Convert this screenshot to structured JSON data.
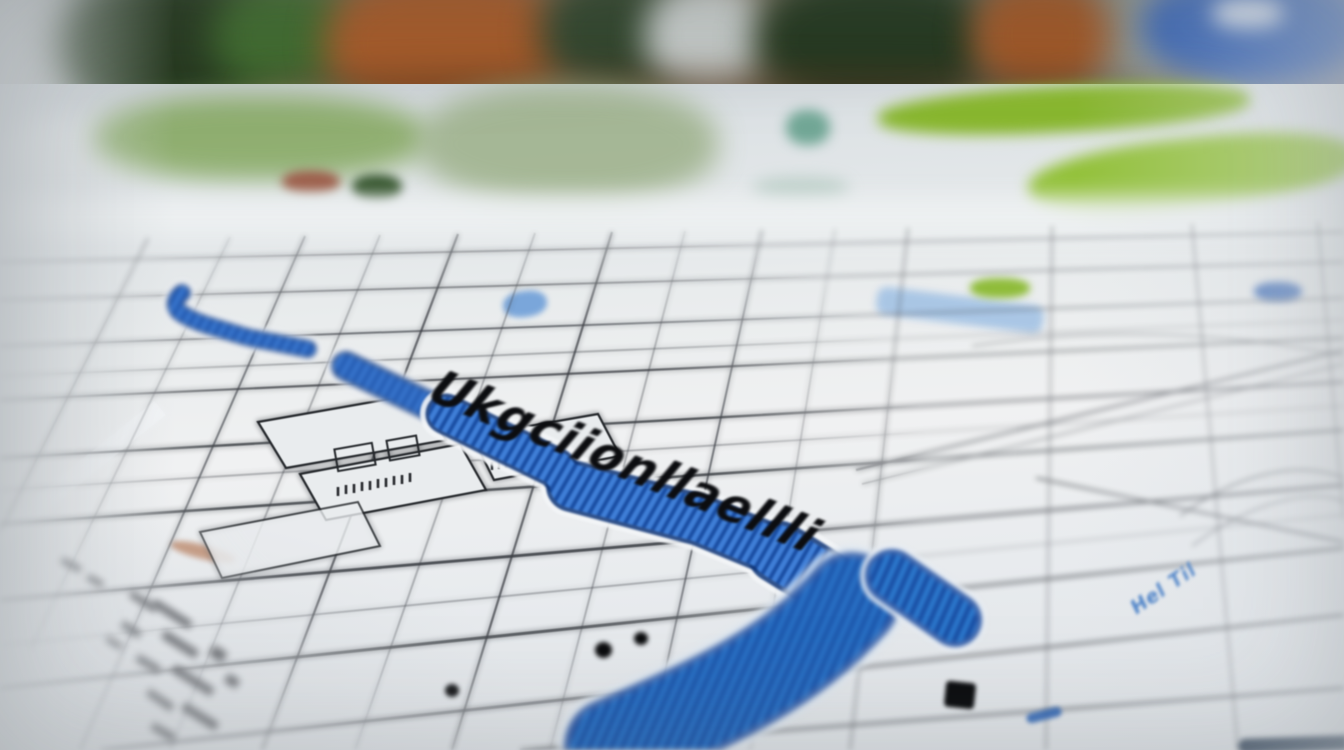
{
  "image": {
    "type": "photograph",
    "subject": "Close-up photo of a printed street map with a blue highlighted route, blurred outdoor background",
    "route_label": "Ukgciionllaellli",
    "street_label": "Hel Til",
    "colors": {
      "route_blue": "#3f7ed6",
      "route_dark_blue": "#1b4fa4",
      "paper": "#eceef0",
      "street_line": "#3b3e44",
      "park_green_bright": "#8ab832",
      "park_green_muted": "#7ea355",
      "water_blue": "#6f9fd8",
      "background_wall_orange": "#a65a28",
      "background_foliage_green": "#2c3f24",
      "background_object_blue": "#2757ae"
    },
    "markers": {
      "poi_dot_count": 3,
      "poi_square_count": 1
    }
  }
}
